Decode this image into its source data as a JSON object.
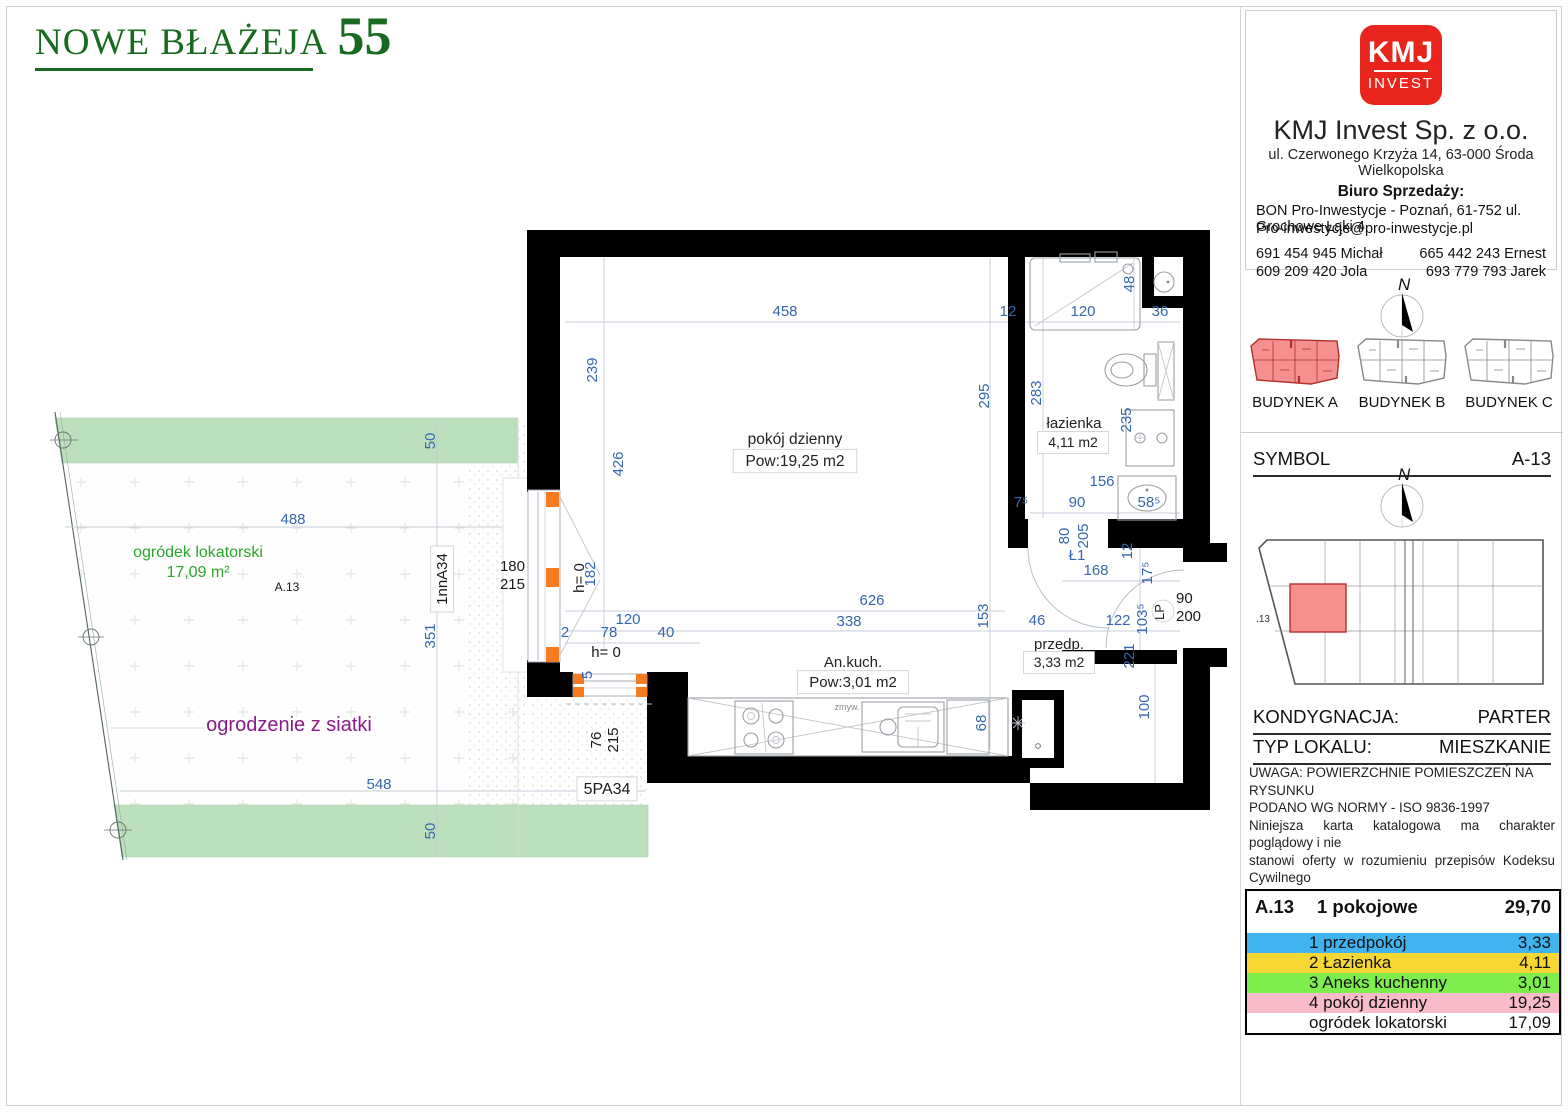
{
  "page": {
    "title_left": "NOWE BŁAŻEJA",
    "title_number": "55"
  },
  "sidebar": {
    "logo": {
      "top": "KMJ",
      "bottom": "INVEST"
    },
    "company_name": "KMJ Invest Sp. z o.o.",
    "company_address": "ul. Czerwonego Krzyża 14, 63-000 Środa Wielkopolska",
    "sales_heading": "Biuro Sprzedaży:",
    "sales_line1": "BON Pro-Inwestycje - Poznań, 61-752 ul. Grochowe Łąki 4",
    "sales_line2": "Pro-inwestycje@pro-inwestycje.pl",
    "phones": {
      "r1c1": "691 454 945 Michał",
      "r1c2": "665 442 243 Ernest",
      "r2c1": "609 209 420 Jola",
      "r2c2": "693 779 793 Jarek"
    },
    "compass_n": "N",
    "buildings": {
      "a": "BUDYNEK A",
      "b": "BUDYNEK B",
      "c": "BUDYNEK C"
    },
    "symbol_label": "SYMBOL",
    "symbol_value": "A-13",
    "overview_unit": ".13",
    "kondygnacja_label": "KONDYGNACJA:",
    "kondygnacja_value": "PARTER",
    "typ_label": "TYP LOKALU:",
    "typ_value": "MIESZKANIE",
    "disclaimer": {
      "l1": "UWAGA: POWIERZCHNIE POMIESZCZEŃ NA RYSUNKU",
      "l2": "PODANO WG NORMY - ISO 9836-1997",
      "l3": "Niniejsza karta katalogowa ma charakter poglądowy i nie",
      "l4": "stanowi oferty w rozumieniu przepisów Kodeksu Cywilnego"
    },
    "table": {
      "unit": "A.13",
      "type": "1 pokojowe",
      "total": "29,70",
      "rows": [
        {
          "name": "1 przedpokój",
          "area": "3,33",
          "color": "#41b3ee"
        },
        {
          "name": "2 Łazienka",
          "area": "4,11",
          "color": "#f6d733"
        },
        {
          "name": "3 Aneks kuchenny",
          "area": "3,01",
          "color": "#7dee4b"
        },
        {
          "name": "4 pokój dzienny",
          "area": "19,25",
          "color": "#f9bac9"
        },
        {
          "name": "ogródek lokatorski",
          "area": "17,09",
          "color": "#ffffff"
        }
      ]
    }
  },
  "plan": {
    "accent_colors": {
      "dimension_blue": "#3766ae",
      "garden_green_text": "#2da42d",
      "fence_purple": "#8a1b8a",
      "window_orange": "#f47b20",
      "garden_band_green": "#bcdfbc",
      "highlight_red": "#f59090"
    },
    "labels": [
      {
        "t": "458",
        "x": 785,
        "y": 316,
        "cls": "dim",
        "n": "dim-458"
      },
      {
        "t": "12",
        "x": 1008,
        "y": 316,
        "cls": "dim",
        "n": "dim-12-top"
      },
      {
        "t": "120",
        "x": 1083,
        "y": 316,
        "cls": "dim",
        "n": "dim-120-bath"
      },
      {
        "t": "36",
        "x": 1160,
        "y": 316,
        "cls": "dim",
        "n": "dim-36"
      },
      {
        "t": "48",
        "x": 1134,
        "y": 284,
        "r": -90,
        "cls": "dim",
        "n": "dim-48"
      },
      {
        "t": "239",
        "x": 597,
        "y": 370,
        "r": -90,
        "cls": "dim",
        "n": "dim-239"
      },
      {
        "t": "426",
        "x": 623,
        "y": 464,
        "r": -90,
        "cls": "dim",
        "n": "dim-426"
      },
      {
        "t": "295",
        "x": 989,
        "y": 396,
        "r": -90,
        "cls": "dim",
        "n": "dim-295"
      },
      {
        "t": "283",
        "x": 1041,
        "y": 393,
        "r": -90,
        "cls": "dim",
        "n": "dim-283"
      },
      {
        "t": "235",
        "x": 1131,
        "y": 420,
        "r": -90,
        "cls": "dim",
        "n": "dim-235"
      },
      {
        "t": "156",
        "x": 1102,
        "y": 486,
        "cls": "dim",
        "n": "dim-156"
      },
      {
        "t": "90",
        "x": 1077,
        "y": 507,
        "cls": "dim",
        "n": "dim-90-bath"
      },
      {
        "t": "58⁵",
        "x": 1149,
        "y": 507,
        "cls": "dim",
        "n": "dim-585"
      },
      {
        "t": "7⁵",
        "x": 1021,
        "y": 507,
        "cls": "dim",
        "n": "dim-75"
      },
      {
        "t": "80",
        "x": 1069,
        "y": 536,
        "r": -90,
        "cls": "dim",
        "n": "dim-80"
      },
      {
        "t": "205",
        "x": 1088,
        "y": 536,
        "r": -90,
        "cls": "dim",
        "n": "dim-205"
      },
      {
        "t": "Ł1",
        "x": 1077,
        "y": 560,
        "cls": "dim",
        "n": "door-label-l1"
      },
      {
        "t": "12",
        "x": 1132,
        "y": 551,
        "r": -90,
        "cls": "dim",
        "n": "dim-12-mid"
      },
      {
        "t": "168",
        "x": 1096,
        "y": 575,
        "cls": "dim",
        "n": "dim-168"
      },
      {
        "t": "17⁵",
        "x": 1152,
        "y": 573,
        "r": -90,
        "cls": "dim",
        "n": "dim-175"
      },
      {
        "t": "626",
        "x": 872,
        "y": 605,
        "cls": "dim",
        "n": "dim-626"
      },
      {
        "t": "338",
        "x": 849,
        "y": 626,
        "cls": "dim",
        "n": "dim-338"
      },
      {
        "t": "153",
        "x": 988,
        "y": 616,
        "r": -90,
        "cls": "dim",
        "n": "dim-153"
      },
      {
        "t": "46",
        "x": 1037,
        "y": 625,
        "cls": "dim",
        "n": "dim-46"
      },
      {
        "t": "122",
        "x": 1118,
        "y": 625,
        "cls": "dim",
        "n": "dim-122"
      },
      {
        "t": "103⁵",
        "x": 1147,
        "y": 619,
        "r": -90,
        "cls": "dim",
        "n": "dim-1035"
      },
      {
        "t": "221",
        "x": 1134,
        "y": 656,
        "r": -90,
        "cls": "dim",
        "n": "dim-221"
      },
      {
        "t": "100",
        "x": 1149,
        "y": 707,
        "r": -90,
        "cls": "dim",
        "n": "dim-100"
      },
      {
        "t": "120",
        "x": 628,
        "y": 624,
        "cls": "dim",
        "n": "dim-120-win"
      },
      {
        "t": "78",
        "x": 609,
        "y": 637,
        "cls": "dim",
        "n": "dim-78"
      },
      {
        "t": "40",
        "x": 666,
        "y": 637,
        "cls": "dim",
        "n": "dim-40"
      },
      {
        "t": "2",
        "x": 565,
        "y": 637,
        "cls": "dim",
        "n": "dim-2"
      },
      {
        "t": "182",
        "x": 595,
        "y": 574,
        "r": -90,
        "cls": "dim",
        "n": "dim-182"
      },
      {
        "t": "5",
        "x": 592,
        "y": 675,
        "r": -90,
        "cls": "dim",
        "n": "dim-5"
      },
      {
        "t": "68",
        "x": 986,
        "y": 723,
        "r": -90,
        "cls": "dim",
        "n": "dim-68"
      },
      {
        "t": "488",
        "x": 293,
        "y": 524,
        "cls": "dim",
        "n": "dim-488"
      },
      {
        "t": "548",
        "x": 379,
        "y": 789,
        "cls": "dim",
        "n": "dim-548"
      },
      {
        "t": "50",
        "x": 435,
        "y": 441,
        "r": -90,
        "cls": "dim",
        "n": "dim-50-top"
      },
      {
        "t": "351",
        "x": 435,
        "y": 636,
        "r": -90,
        "cls": "dim",
        "n": "dim-351"
      },
      {
        "t": "50",
        "x": 435,
        "y": 831,
        "r": -90,
        "cls": "dim",
        "n": "dim-50-bottom"
      },
      {
        "t": "h= 0",
        "x": 584,
        "y": 578,
        "r": -90,
        "cls": "blk",
        "n": "label-h0-window"
      },
      {
        "t": "h= 0",
        "x": 606,
        "y": 657,
        "cls": "blk",
        "n": "label-h0-kitchen"
      },
      {
        "t": "180",
        "x": 525,
        "y": 571,
        "a": "end",
        "cls": "blk",
        "n": "dim-180"
      },
      {
        "t": "215",
        "x": 525,
        "y": 589,
        "a": "end",
        "cls": "blk",
        "n": "dim-215-door"
      },
      {
        "t": "76",
        "x": 601,
        "y": 740,
        "r": -90,
        "cls": "blk",
        "n": "dim-76"
      },
      {
        "t": "215",
        "x": 618,
        "y": 740,
        "r": -90,
        "cls": "blk",
        "n": "dim-215-win"
      },
      {
        "t": "90",
        "x": 1176,
        "y": 603,
        "a": "start",
        "cls": "blk",
        "n": "dim-entry-90"
      },
      {
        "t": "200",
        "x": 1176,
        "y": 621,
        "a": "start",
        "cls": "blk",
        "n": "dim-entry-200"
      },
      {
        "t": "LP",
        "x": 1164,
        "y": 612,
        "r": -90,
        "s": 13,
        "cls": "blk",
        "n": "door-label-lp"
      },
      {
        "t": "A.13",
        "x": 287,
        "y": 591,
        "s": 12,
        "cls": "blk",
        "n": "garden-unit-label"
      },
      {
        "t": "5PA34",
        "x": 607,
        "y": 794,
        "s": 16,
        "cls": "blk",
        "box": true,
        "n": "window-code-5pa34"
      },
      {
        "t": "1nnA34",
        "x": 447,
        "y": 579,
        "r": -90,
        "s": 15,
        "cls": "blk",
        "box": true,
        "n": "window-code-1nna34"
      },
      {
        "t": "zmyw.",
        "x": 847,
        "y": 710,
        "s": 9,
        "cls": "gry",
        "n": "sink-label"
      },
      {
        "t": "pokój dzienny",
        "x": 795,
        "y": 444,
        "s": 15.5,
        "cls": "room",
        "n": "room-living-name"
      },
      {
        "t": "Pow:19,25 m2",
        "x": 795,
        "y": 466,
        "s": 15.5,
        "cls": "room",
        "box": true,
        "n": "room-living-area"
      },
      {
        "t": "łazienka",
        "x": 1074,
        "y": 428,
        "s": 15,
        "cls": "room",
        "n": "room-bathroom-name"
      },
      {
        "t": "4,11 m2",
        "x": 1073,
        "y": 447,
        "s": 14,
        "cls": "room",
        "box": true,
        "n": "room-bathroom-area"
      },
      {
        "t": "An.kuch.",
        "x": 853,
        "y": 667,
        "s": 15,
        "cls": "room",
        "n": "room-kitchen-name"
      },
      {
        "t": "Pow:3,01 m2",
        "x": 853,
        "y": 687,
        "s": 15,
        "cls": "room",
        "box": true,
        "n": "room-kitchen-area"
      },
      {
        "t": "przedp.",
        "x": 1059,
        "y": 649,
        "s": 15,
        "cls": "room",
        "n": "room-hall-name"
      },
      {
        "t": "3,33 m2",
        "x": 1059,
        "y": 667,
        "s": 14,
        "cls": "room",
        "box": true,
        "n": "room-hall-area"
      },
      {
        "t": "ogródek lokatorski",
        "x": 198,
        "y": 557,
        "s": 16,
        "cls": "grn",
        "n": "garden-name"
      },
      {
        "t": "17,09 m²",
        "x": 198,
        "y": 577,
        "s": 16,
        "cls": "grn",
        "n": "garden-area"
      },
      {
        "t": "ogrodzenie z siatki",
        "x": 289,
        "y": 731,
        "s": 20,
        "cls": "pur",
        "n": "fence-label"
      }
    ]
  }
}
